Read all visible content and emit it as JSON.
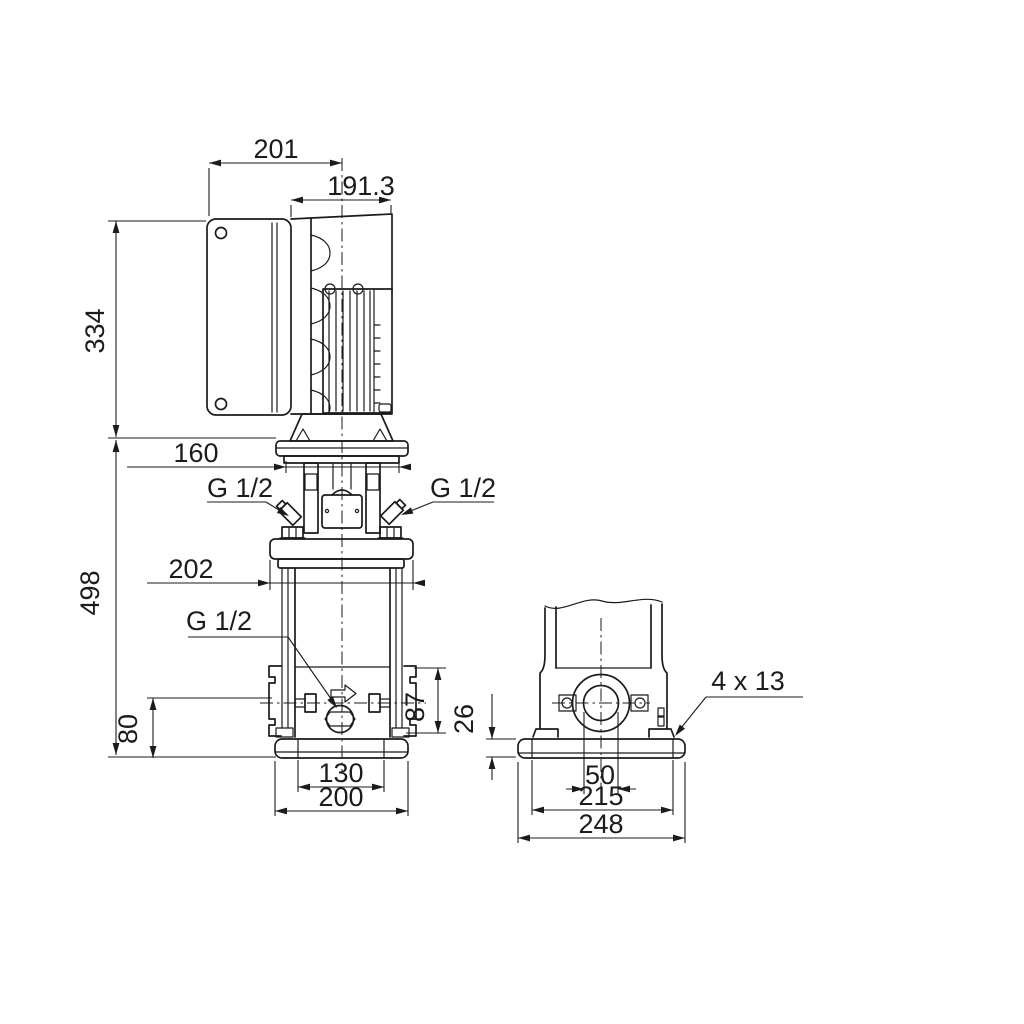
{
  "drawing": {
    "type": "pump-dimensional-drawing",
    "background_color": "#ffffff",
    "line_color": "#1b1b1b",
    "dims": {
      "d201": "201",
      "d1913": "191.3",
      "d334": "334",
      "d160": "160",
      "d498": "498",
      "d202": "202",
      "d80": "80",
      "d87": "87",
      "d130": "130",
      "d200": "200",
      "d26": "26",
      "d50": "50",
      "d215": "215",
      "d248": "248",
      "g12_top_left": "G 1/2",
      "g12_top_right": "G 1/2",
      "g12_drain": "G 1/2",
      "bolt_holes": "4 x 13"
    }
  }
}
